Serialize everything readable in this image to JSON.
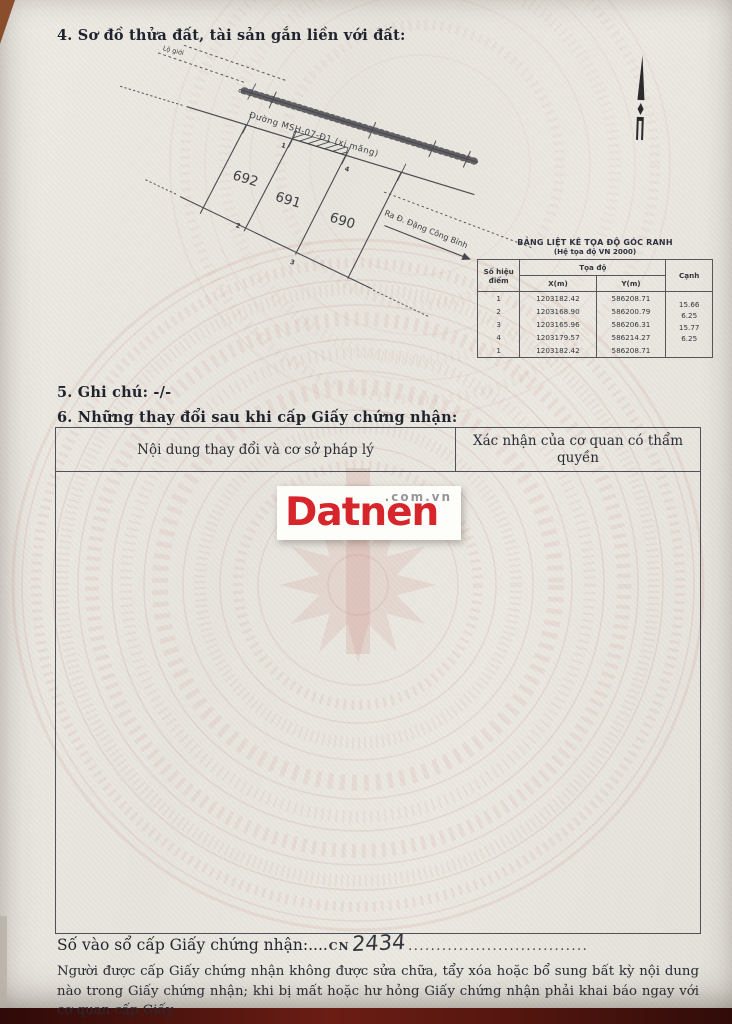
{
  "document": {
    "section4_title": "4. Sơ đồ thửa đất, tài sản gắn liền với đất:",
    "section5_title": "5. Ghi chú: -/-",
    "section6_title": "6. Những thay đổi sau khi cấp Giấy chứng nhận:",
    "registry_label": "Số vào sổ cấp Giấy chứng nhận:....",
    "registry_prefix": "CN",
    "registry_number": "2434",
    "registry_dots": "................................",
    "footer_note": "Người được cấp Giấy chứng nhận không được sửa chữa, tẩy xóa hoặc bổ sung bất kỳ nội dung nào trong Giấy chứng nhận; khi bị mất hoặc hư hỏng Giấy chứng nhận phải khai báo ngay với cơ quan cấp Giấy."
  },
  "diagram": {
    "road_label": "Đường MSH-07-Đ1 (xi măng)",
    "direction_label": "Ra Đ. Đặng Công Bỉnh",
    "boundary_labels": [
      "Lộ giới",
      "Lộ giới"
    ],
    "road_width": "8",
    "parcel_labels": [
      "692",
      "691",
      "690"
    ],
    "corner_labels": [
      "1",
      "2",
      "3",
      "4"
    ]
  },
  "coord_table": {
    "title": "BẢNG LIỆT KÊ TỌA ĐỘ GÓC RANH",
    "subtitle": "(Hệ tọa độ VN 2000)",
    "headers": {
      "point": "Số hiệu điểm",
      "coord": "Tọa độ",
      "x": "X(m)",
      "y": "Y(m)",
      "edge": "Cạnh"
    },
    "rows": [
      {
        "point": "1",
        "x": "1203182.42",
        "y": "586208.71"
      },
      {
        "point": "2",
        "x": "1203168.90",
        "y": "586200.79"
      },
      {
        "point": "3",
        "x": "1203165.96",
        "y": "586206.31"
      },
      {
        "point": "4",
        "x": "1203179.57",
        "y": "586214.27"
      },
      {
        "point": "1",
        "x": "1203182.42",
        "y": "586208.71"
      }
    ],
    "edges": [
      "15.66",
      "6.25",
      "15.77",
      "6.25"
    ]
  },
  "changes_table": {
    "col_content": "Nội dung thay đổi và cơ sở pháp lý",
    "col_confirm": "Xác nhận của cơ quan có thẩm quyền"
  },
  "watermark": {
    "brand": "Datnen",
    "suffix": ".com.vn",
    "brand_color": "#d6262b"
  }
}
